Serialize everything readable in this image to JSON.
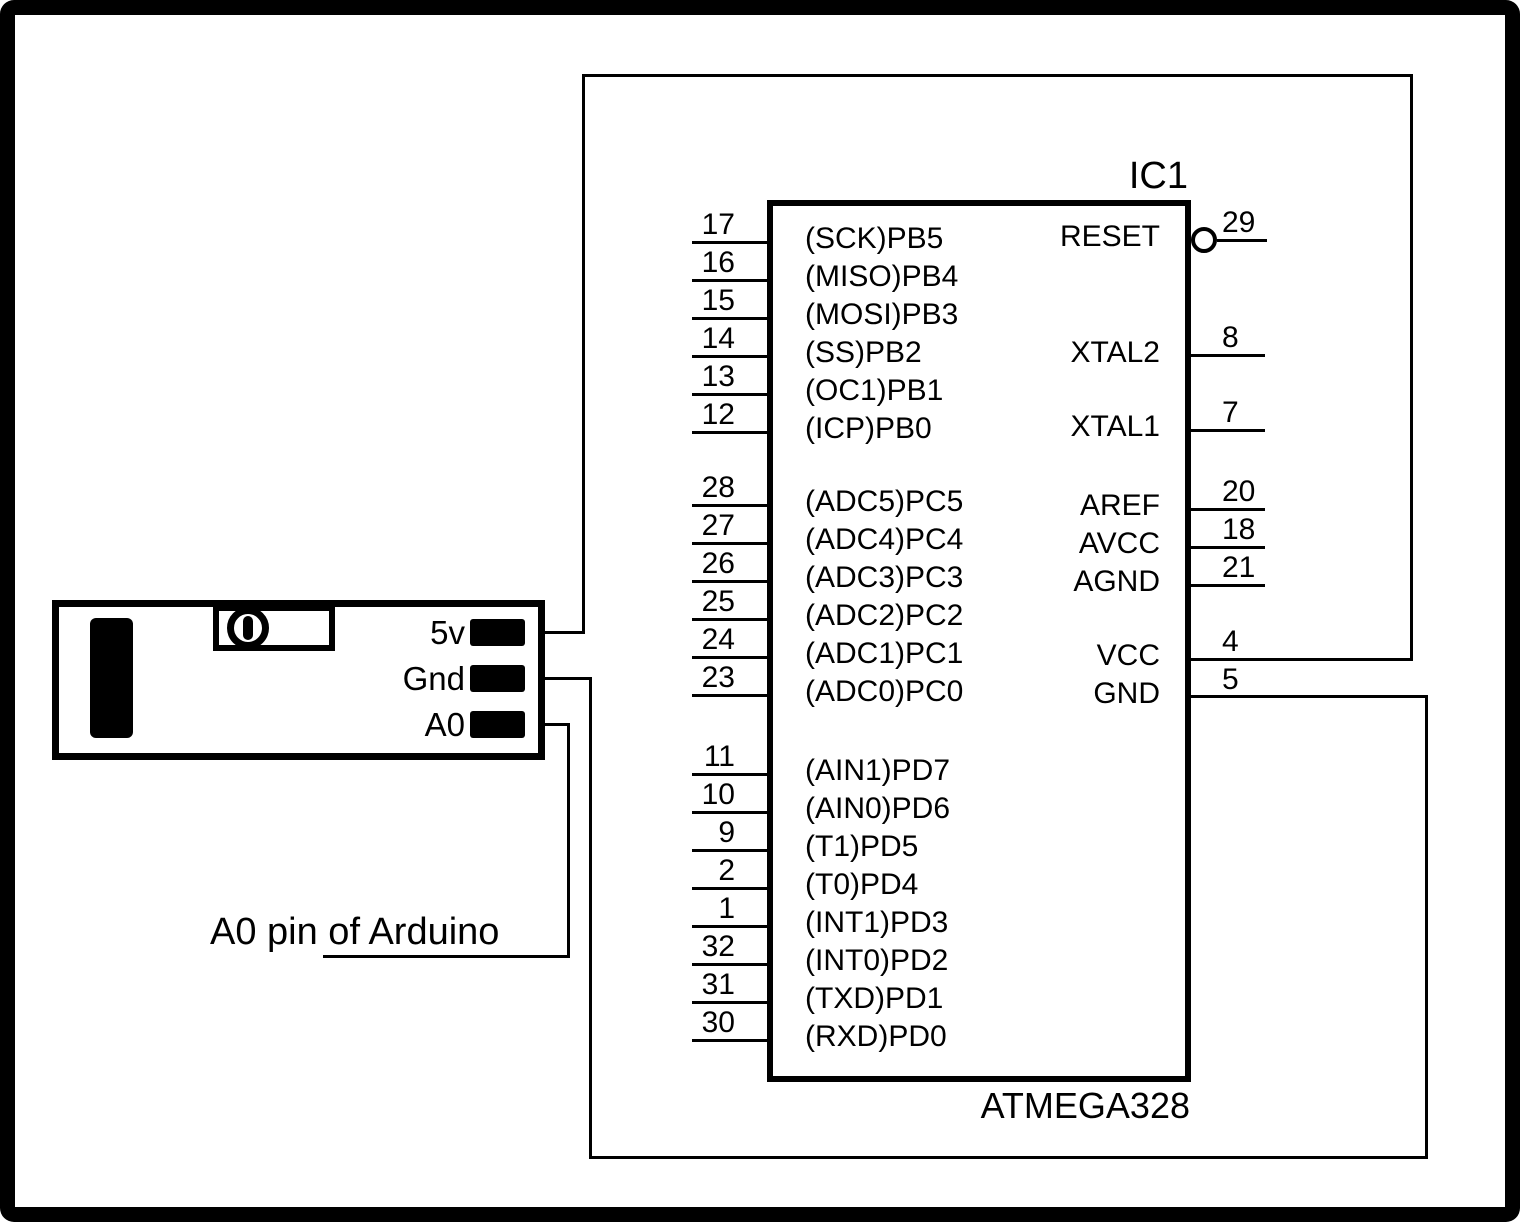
{
  "colors": {
    "ink": "#000000",
    "background": "#ffffff"
  },
  "ic": {
    "designator": "IC1",
    "part_number": "ATMEGA328",
    "left_pins": [
      {
        "num": "17",
        "label": "(SCK)PB5"
      },
      {
        "num": "16",
        "label": "(MISO)PB4"
      },
      {
        "num": "15",
        "label": "(MOSI)PB3"
      },
      {
        "num": "14",
        "label": "(SS)PB2"
      },
      {
        "num": "13",
        "label": "(OC1)PB1"
      },
      {
        "num": "12",
        "label": "(ICP)PB0"
      },
      {
        "num": "28",
        "label": "(ADC5)PC5"
      },
      {
        "num": "27",
        "label": "(ADC4)PC4"
      },
      {
        "num": "26",
        "label": "(ADC3)PC3"
      },
      {
        "num": "25",
        "label": "(ADC2)PC2"
      },
      {
        "num": "24",
        "label": "(ADC1)PC1"
      },
      {
        "num": "23",
        "label": "(ADC0)PC0"
      },
      {
        "num": "11",
        "label": "(AIN1)PD7"
      },
      {
        "num": "10",
        "label": "(AIN0)PD6"
      },
      {
        "num": "9",
        "label": "(T1)PD5"
      },
      {
        "num": "2",
        "label": "(T0)PD4"
      },
      {
        "num": "1",
        "label": "(INT1)PD3"
      },
      {
        "num": "32",
        "label": "(INT0)PD2"
      },
      {
        "num": "31",
        "label": "(TXD)PD1"
      },
      {
        "num": "30",
        "label": "(RXD)PD0"
      }
    ],
    "right_pins": [
      {
        "num": "29",
        "label": "RESET"
      },
      {
        "num": "8",
        "label": "XTAL2"
      },
      {
        "num": "7",
        "label": "XTAL1"
      },
      {
        "num": "20",
        "label": "AREF"
      },
      {
        "num": "18",
        "label": "AVCC"
      },
      {
        "num": "21",
        "label": "AGND"
      },
      {
        "num": "4",
        "label": "VCC"
      },
      {
        "num": "5",
        "label": "GND"
      }
    ]
  },
  "sensor_module": {
    "pins": [
      {
        "label": "5v"
      },
      {
        "label": "Gnd"
      },
      {
        "label": "A0"
      }
    ],
    "icons": {
      "sensor_element": "black-bar-sensor",
      "trimmer": "potentiometer-dial"
    }
  },
  "annotation": {
    "text": "A0 pin of Arduino"
  },
  "icons": {
    "reset_bubble": "active-low-bubble"
  }
}
